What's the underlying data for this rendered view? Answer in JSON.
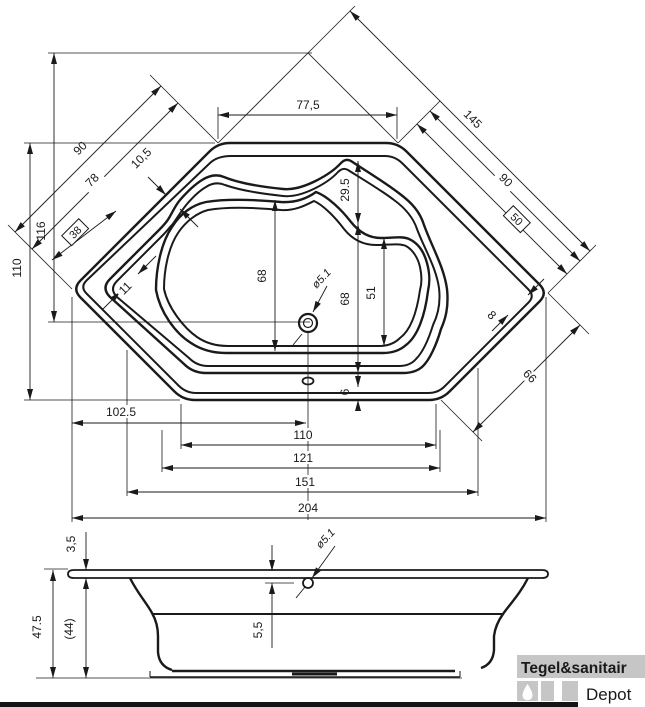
{
  "plan": {
    "top_width": "77,5",
    "back_edge_right": "145",
    "back_edge_right_inner": "90",
    "boxed_right": "50",
    "rim_gap_right": "8",
    "front_edge_right": "66",
    "back_edge_left": "90",
    "back_edge_left_inner": "78",
    "boxed_left": "38",
    "rim_gap_left": "10,5",
    "rim_gap_lower_left": "11",
    "apex_height": "116",
    "side_height": "110",
    "headrest_depth": "29.5",
    "basin_height_left": "68",
    "basin_height_right": "68",
    "basin_width_right": "51",
    "rim_width_bottom": "6",
    "drain_offset": "102.5",
    "bottom_width_110": "110",
    "bottom_width_121": "121",
    "bottom_width_151": "151",
    "total_width": "204",
    "drain_diameter": "ø5.1"
  },
  "side": {
    "rim_thickness": "3,5",
    "total_height": "47.5",
    "body_height": "(44)",
    "drain_depth": "5,5",
    "drain_diameter": "ø5.1"
  },
  "logo": {
    "brand": "Tegel&sanitair",
    "sub": "Depot"
  },
  "colors": {
    "line": "#1a1a1a",
    "logo_gray": "#c6c6c6",
    "logo_text": "#ffffff",
    "depot_text": "#d4d4d4",
    "bar_black": "#141414"
  }
}
